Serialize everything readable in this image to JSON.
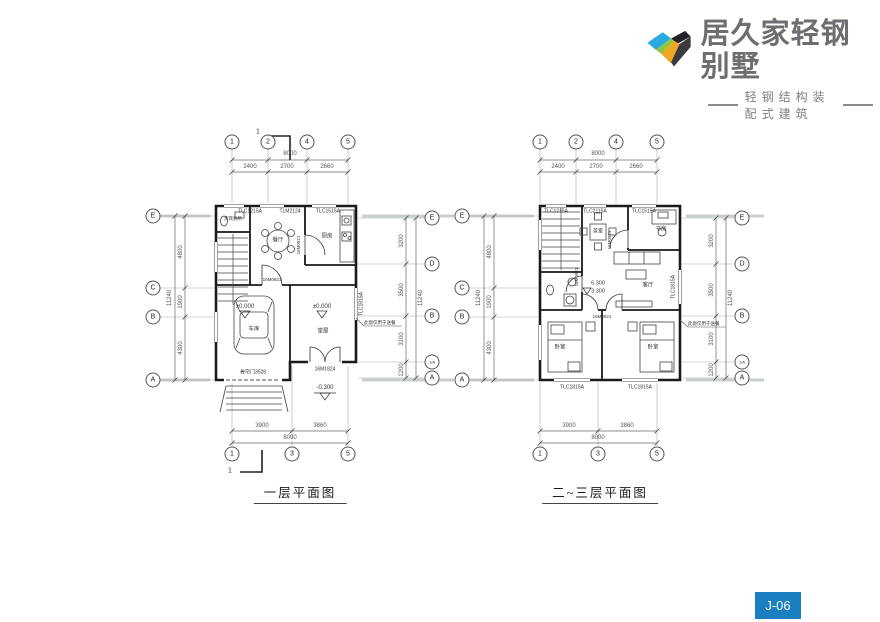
{
  "brand": {
    "name": "居久家轻钢别墅",
    "tagline": "轻钢结构装配式建筑",
    "text_color": "#6d6e71",
    "logo_colors": {
      "blue": "#29aae1",
      "green": "#8ec63f",
      "yellow": "#f0a822",
      "dark": "#232327"
    }
  },
  "badge": {
    "label": "J-06",
    "bg": "#1a7fc0"
  },
  "plans": [
    {
      "title": "一层平面图",
      "section_mark": "1",
      "axes": {
        "top": {
          "bubbles": [
            "1",
            "2",
            "4",
            "5"
          ],
          "overall": "8000",
          "segments": [
            "2400",
            "2700",
            "2660"
          ]
        },
        "bottom": {
          "bubbles": [
            "1",
            "3",
            "5"
          ],
          "overall": "8000",
          "segments": [
            "3900",
            "3860"
          ]
        },
        "left": {
          "bubbles": [
            "E",
            "C",
            "B",
            "A"
          ],
          "overall": "11240",
          "segments": [
            "4800",
            "1900",
            "4300"
          ]
        },
        "right": {
          "bubbles": [
            "E",
            "D",
            "B",
            "1/A",
            "A"
          ],
          "overall": "11240",
          "segments": [
            "3200",
            "3500",
            "3100",
            "1200"
          ]
        }
      },
      "windows": {
        "top": [
          "TLC1215A",
          "TLM2124",
          "TLC1515A"
        ],
        "right": "TLC1815A"
      },
      "rooms": {
        "toilet": "贵宾厕所",
        "dining": "餐厅",
        "kitchen": "厨房",
        "garage": "车库",
        "hall": "堂屋"
      },
      "doors": {
        "interior": "16M0921",
        "kitchen": "16M0921",
        "entry": "16M1824",
        "garage": "卷帘门3528"
      },
      "levels": {
        "ground_a": "±0.000",
        "ground_b": "±0.000",
        "outdoor": "-0.300"
      },
      "note": "此窗仅用于送餐"
    },
    {
      "title": "二~三层平面图",
      "axes": {
        "top": {
          "bubbles": [
            "1",
            "2",
            "4",
            "5"
          ],
          "overall": "8000",
          "segments": [
            "2400",
            "2700",
            "2660"
          ]
        },
        "bottom": {
          "bubbles": [
            "1",
            "3",
            "5"
          ],
          "overall": "8000",
          "segments": [
            "3900",
            "3860"
          ]
        },
        "left": {
          "bubbles": [
            "E",
            "C",
            "B",
            "A"
          ],
          "overall": "11240",
          "segments": [
            "4800",
            "1900",
            "4300"
          ]
        },
        "right": {
          "bubbles": [
            "E",
            "D",
            "B",
            "1/A",
            "A"
          ],
          "overall": "11240",
          "segments": [
            "3200",
            "3500",
            "3100",
            "1200"
          ]
        }
      },
      "windows": {
        "top": [
          "TLC1215A",
          "TLC2115A",
          "TLC1515A"
        ],
        "bottom": [
          "TLC1815A",
          "TLC1815A"
        ],
        "right": "TLC1815A"
      },
      "rooms": {
        "tea": "茶室",
        "study": "书房",
        "living": "客厅",
        "bed1": "卧室",
        "bed2": "卧室"
      },
      "doors": {
        "d1": "16M0921",
        "d2": "16M0921",
        "d3": "16M0921"
      },
      "levels": {
        "l3": "6.300",
        "l2": "3.300"
      },
      "note": "此窗仅用于送餐"
    }
  ]
}
